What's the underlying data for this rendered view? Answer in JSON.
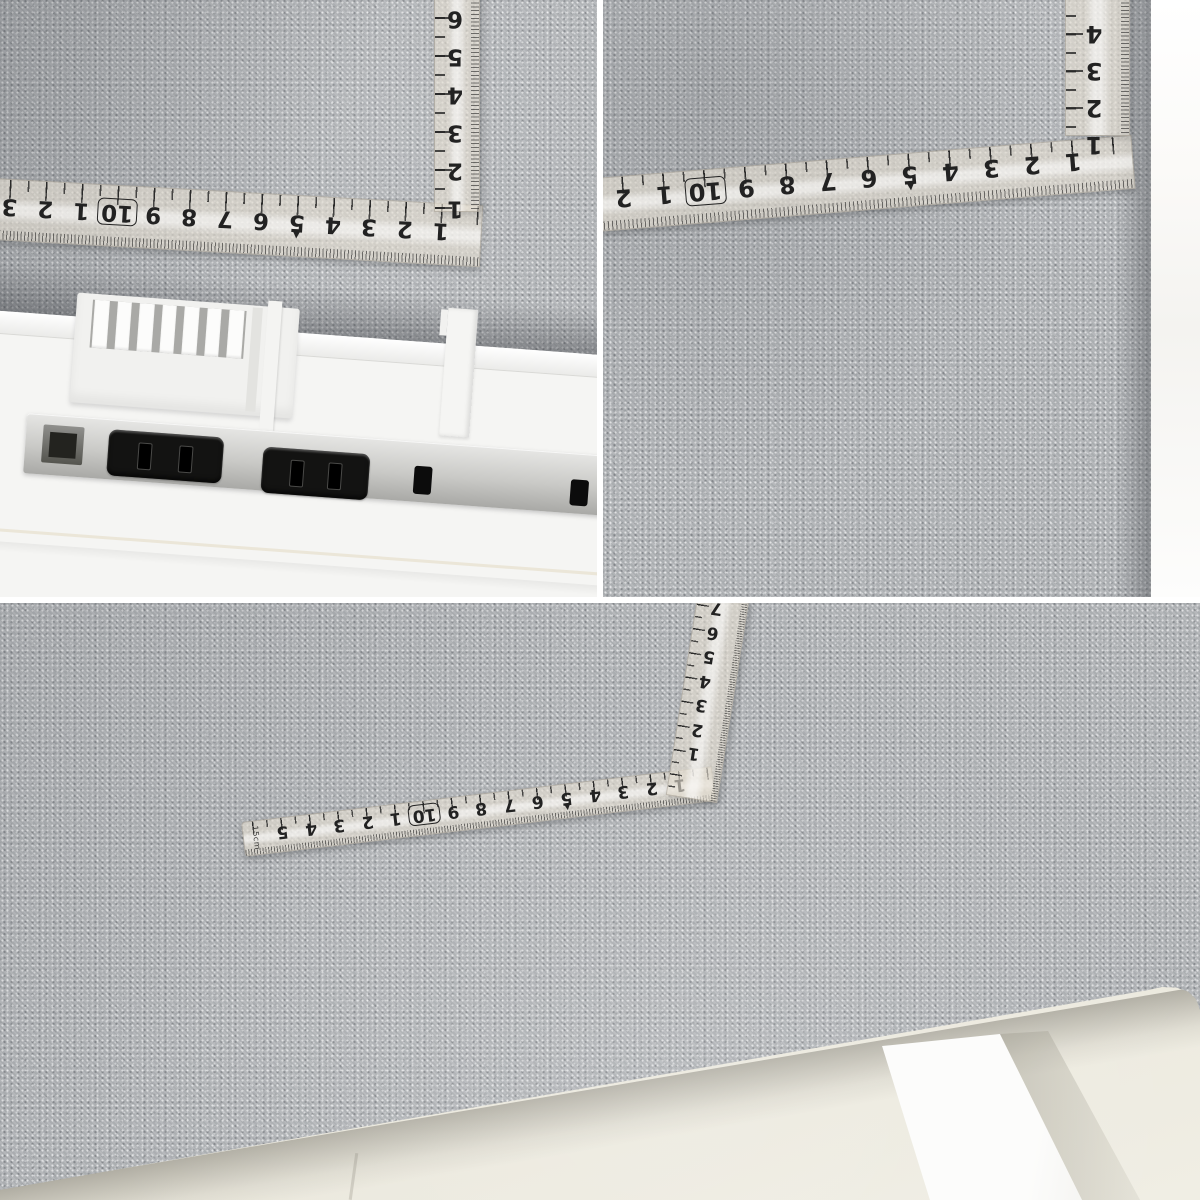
{
  "tiles": {
    "top_left": {
      "ruler": {
        "horizontal": {
          "labels": [
            "3",
            "2",
            "1",
            "10",
            "9",
            "8",
            "7",
            "6",
            "5",
            "4",
            "3",
            "2",
            "1"
          ],
          "boxed": "10",
          "marker": "▼"
        },
        "vertical": {
          "labels": [
            "6",
            "5",
            "4",
            "3",
            "2",
            "1"
          ]
        }
      }
    },
    "top_right": {
      "ruler": {
        "horizontal": {
          "labels": [
            "2",
            "1",
            "10",
            "9",
            "8",
            "7",
            "6",
            "5",
            "4",
            "3",
            "2",
            "1"
          ],
          "boxed": "10",
          "marker": "▼"
        },
        "vertical": {
          "labels": [
            "4",
            "3",
            "2",
            "1"
          ]
        }
      }
    },
    "bottom": {
      "ruler": {
        "horizontal": {
          "labels": [
            "5",
            "4",
            "3",
            "2",
            "1",
            "10",
            "9",
            "8",
            "7",
            "6",
            "5",
            "4",
            "3",
            "2",
            "1"
          ],
          "boxed": "10",
          "marker": "▼",
          "tip_label": "15cm"
        },
        "vertical": {
          "labels": [
            "7",
            "6",
            "5",
            "4",
            "3",
            "2",
            "1"
          ]
        }
      }
    }
  },
  "colors": {
    "fabric_gray": "#b1b4b7",
    "ruler_band": "rgba(229,223,210,0.62)",
    "ruler_ink": "rgba(35,35,35,0.8)",
    "ruler_ink_faint": "rgba(35,35,35,0.6)",
    "ruler_digit": "#222222",
    "desk_white": "#f5f5f3",
    "outlet_strip_silver": "#c9c9c6",
    "outlet_black": "#131312",
    "floor_beige": "#e7e4d8",
    "leg_white": "#fcfcfb",
    "gutter_white": "#ffffff"
  }
}
